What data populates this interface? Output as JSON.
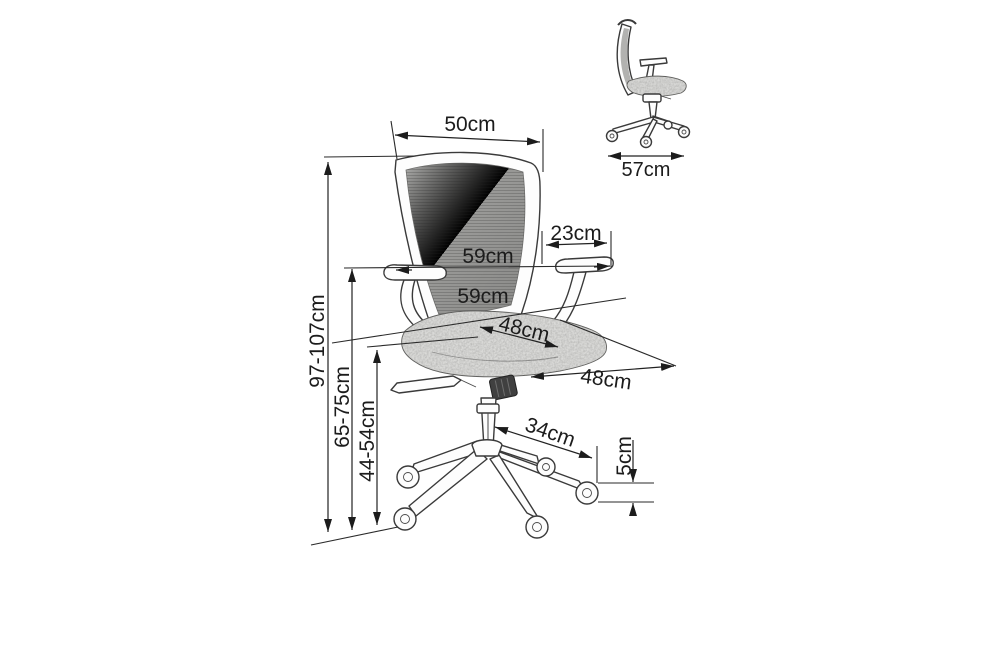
{
  "diagram": {
    "title": "Office chair dimension diagram",
    "units": "cm",
    "labels": {
      "backrest_width": "50cm",
      "overall_depth": "57cm",
      "armrest_length": "23cm",
      "overall_width_top": "59cm",
      "overall_width_bottom": "59cm",
      "seat_width": "48cm",
      "seat_depth": "48cm",
      "overall_height": "97-107cm",
      "armrest_height": "65-75cm",
      "seat_height": "44-54cm",
      "base_radius": "34cm",
      "caster_height": "5cm"
    },
    "views": {
      "main": "front three-quarter view",
      "inset": "side view"
    },
    "colors": {
      "line": "#2b2b2b",
      "mesh": "#969694",
      "seat": "#d9d9d7",
      "background": "#ffffff"
    }
  }
}
